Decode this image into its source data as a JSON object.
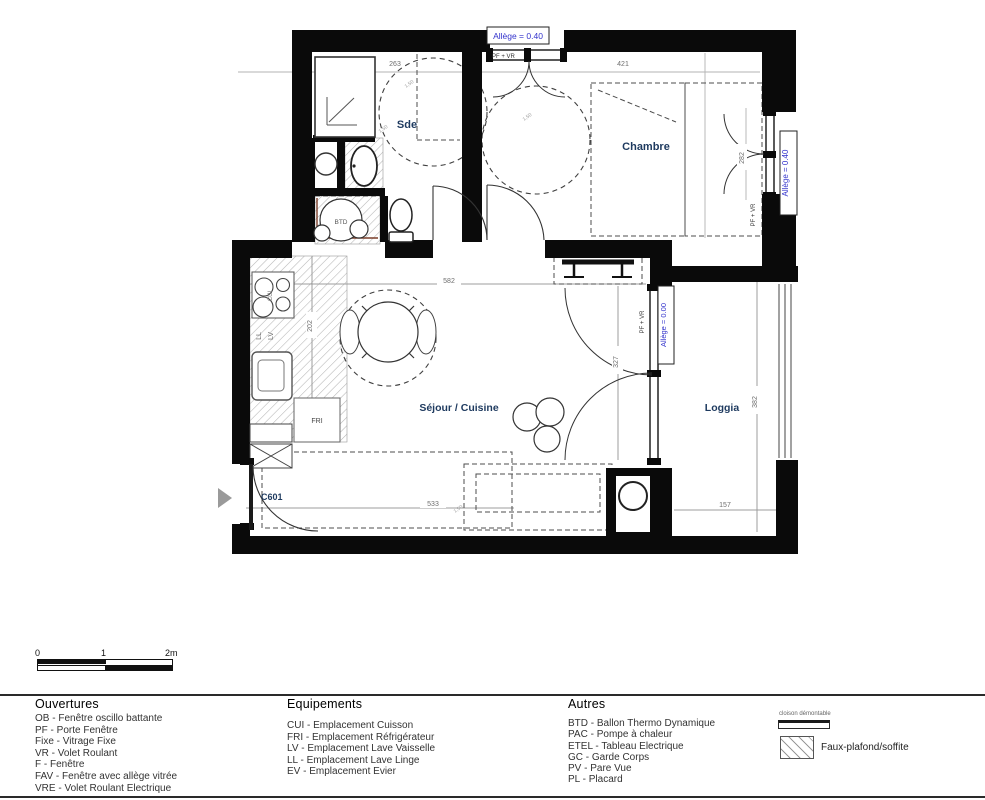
{
  "colors": {
    "wall": "#0a0a0a",
    "allege_blue": "#3333cc",
    "room_navy": "#1e3a5f",
    "dim_grey": "#6e6e6e",
    "hatch_grey": "#b5b5b5",
    "pipe_brown": "#7b3f2a",
    "entry_arrow_grey": "#9a9a9a"
  },
  "plan": {
    "rooms": {
      "sde": "Sde",
      "chambre": "Chambre",
      "sejour": "Séjour / Cuisine",
      "loggia": "Loggia"
    },
    "dims": {
      "sde_top": "263",
      "chambre_top": "421",
      "chambre_window": "282",
      "sejour_width": "582",
      "kitchen_depth": "202",
      "bay_height": "327",
      "loggia_height": "382",
      "loggia_width": "157",
      "entry_width": "533"
    },
    "windows": {
      "allege_040": "Allège = 0.40",
      "allege_000": "Allège = 0.00",
      "pf_vr": "PF + VR"
    },
    "equipment": {
      "btd": "BTD",
      "fri": "FRI",
      "cui": "CUI",
      "ll": "LL",
      "lv": "LV"
    },
    "entry_door": "C601",
    "turning_circle": "1,50"
  },
  "scale_bar": {
    "tick_0": "0",
    "tick_1": "1",
    "tick_2": "2m"
  },
  "legend": {
    "ouvertures": {
      "title": "Ouvertures",
      "items": [
        "OB - Fenêtre oscillo battante",
        "PF - Porte Fenêtre",
        "Fixe - Vitrage Fixe",
        "VR - Volet Roulant",
        "F - Fenêtre",
        "FAV - Fenêtre avec allège vitrée",
        "VRE - Volet Roulant Electrique"
      ]
    },
    "equipements": {
      "title": "Equipements",
      "items": [
        "CUI - Emplacement Cuisson",
        "FRI - Emplacement Réfrigérateur",
        "LV - Emplacement Lave Vaisselle",
        "LL - Emplacement Lave Linge",
        "EV - Emplacement Evier"
      ]
    },
    "autres": {
      "title": "Autres",
      "items": [
        "BTD - Ballon Thermo Dynamique",
        "PAC - Pompe à chaleur",
        "ETEL - Tableau Electrique",
        "GC - Garde Corps",
        "PV - Pare Vue",
        "PL - Placard"
      ]
    },
    "cloison_label": "cloison démontable",
    "faux_plafond_label": "Faux-plafond/soffite"
  }
}
